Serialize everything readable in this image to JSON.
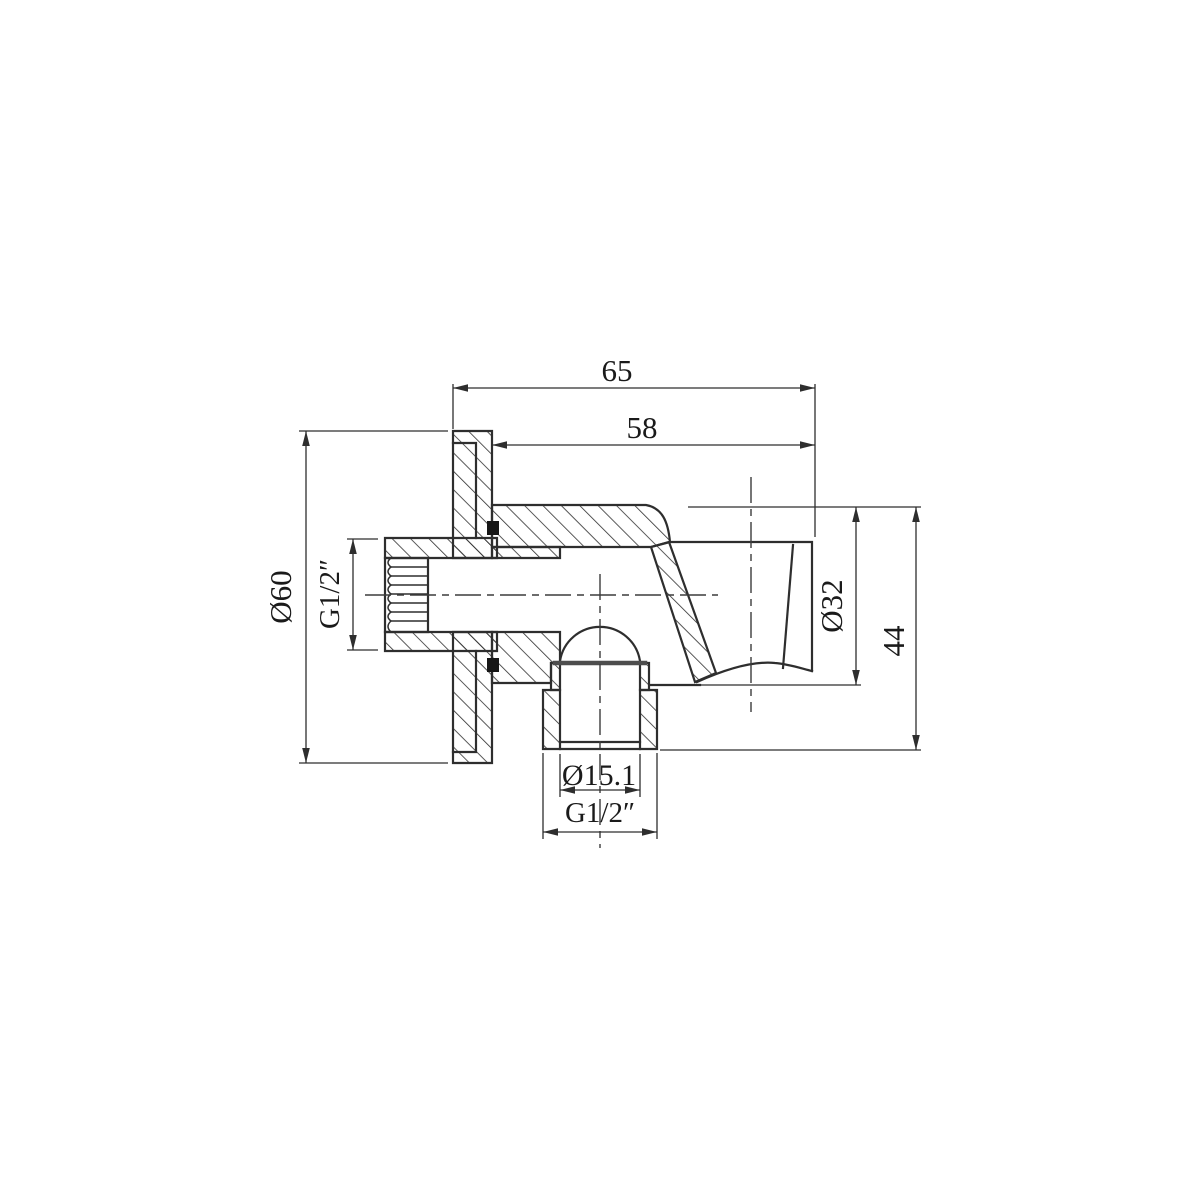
{
  "drawing": {
    "background": "#ffffff",
    "line_color": "#2e2e2e",
    "labels": {
      "overall_depth": "65",
      "projection_depth": "58",
      "flange_diameter": "Ø60",
      "inlet_thread": "G1/2″",
      "holder_diameter": "Ø32",
      "overall_height": "44",
      "outlet_bore": "Ø15.1",
      "outlet_thread": "G1/2″"
    }
  }
}
